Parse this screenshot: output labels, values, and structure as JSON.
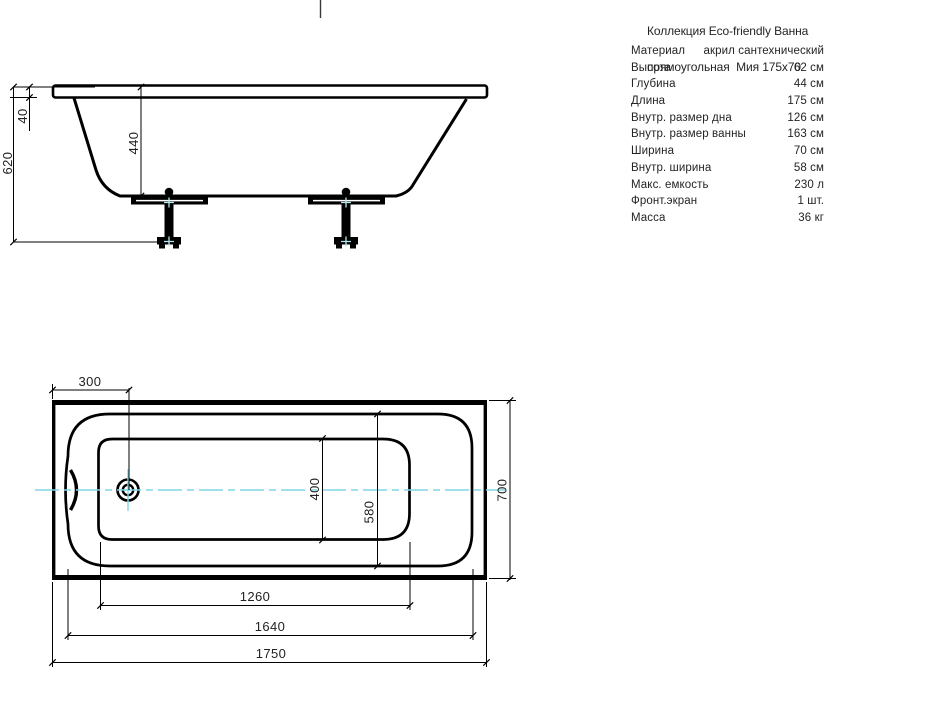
{
  "header": {
    "title_line1": "Коллекция Eco-friendly Ванна",
    "title_line2": "прямоугольная  Мия 175x70"
  },
  "specs": {
    "rows": [
      {
        "label": "Материал",
        "value": "акрил сантехнический"
      },
      {
        "label": "Высота",
        "value": "62 см"
      },
      {
        "label": "Глубина",
        "value": "44 см"
      },
      {
        "label": "Длина",
        "value": "175 см"
      },
      {
        "label": "Внутр. размер дна",
        "value": "126 см"
      },
      {
        "label": "Внутр. размер ванны",
        "value": "163 см"
      },
      {
        "label": "Ширина",
        "value": "70 см"
      },
      {
        "label": "Внутр. ширина",
        "value": "58 см"
      },
      {
        "label": "Макс. емкость",
        "value": "230 л"
      },
      {
        "label": "Фронт.экран",
        "value": "1 шт."
      },
      {
        "label": "Масса",
        "value": "36 кг"
      }
    ]
  },
  "side_view": {
    "dim_total_height": "620",
    "dim_rim_height": "40",
    "dim_inner_depth": "440"
  },
  "top_view": {
    "dim_drain_offset": "300",
    "dim_bottom_width": "400",
    "dim_inner_width": "580",
    "dim_overall_width": "700",
    "dim_bottom_length": "1260",
    "dim_inner_length": "1640",
    "dim_overall_length": "1750"
  },
  "colors": {
    "line": "#000000",
    "centerline": "#7fd7e7",
    "leg_marker": "#b5e7ef",
    "text": "#242424"
  }
}
